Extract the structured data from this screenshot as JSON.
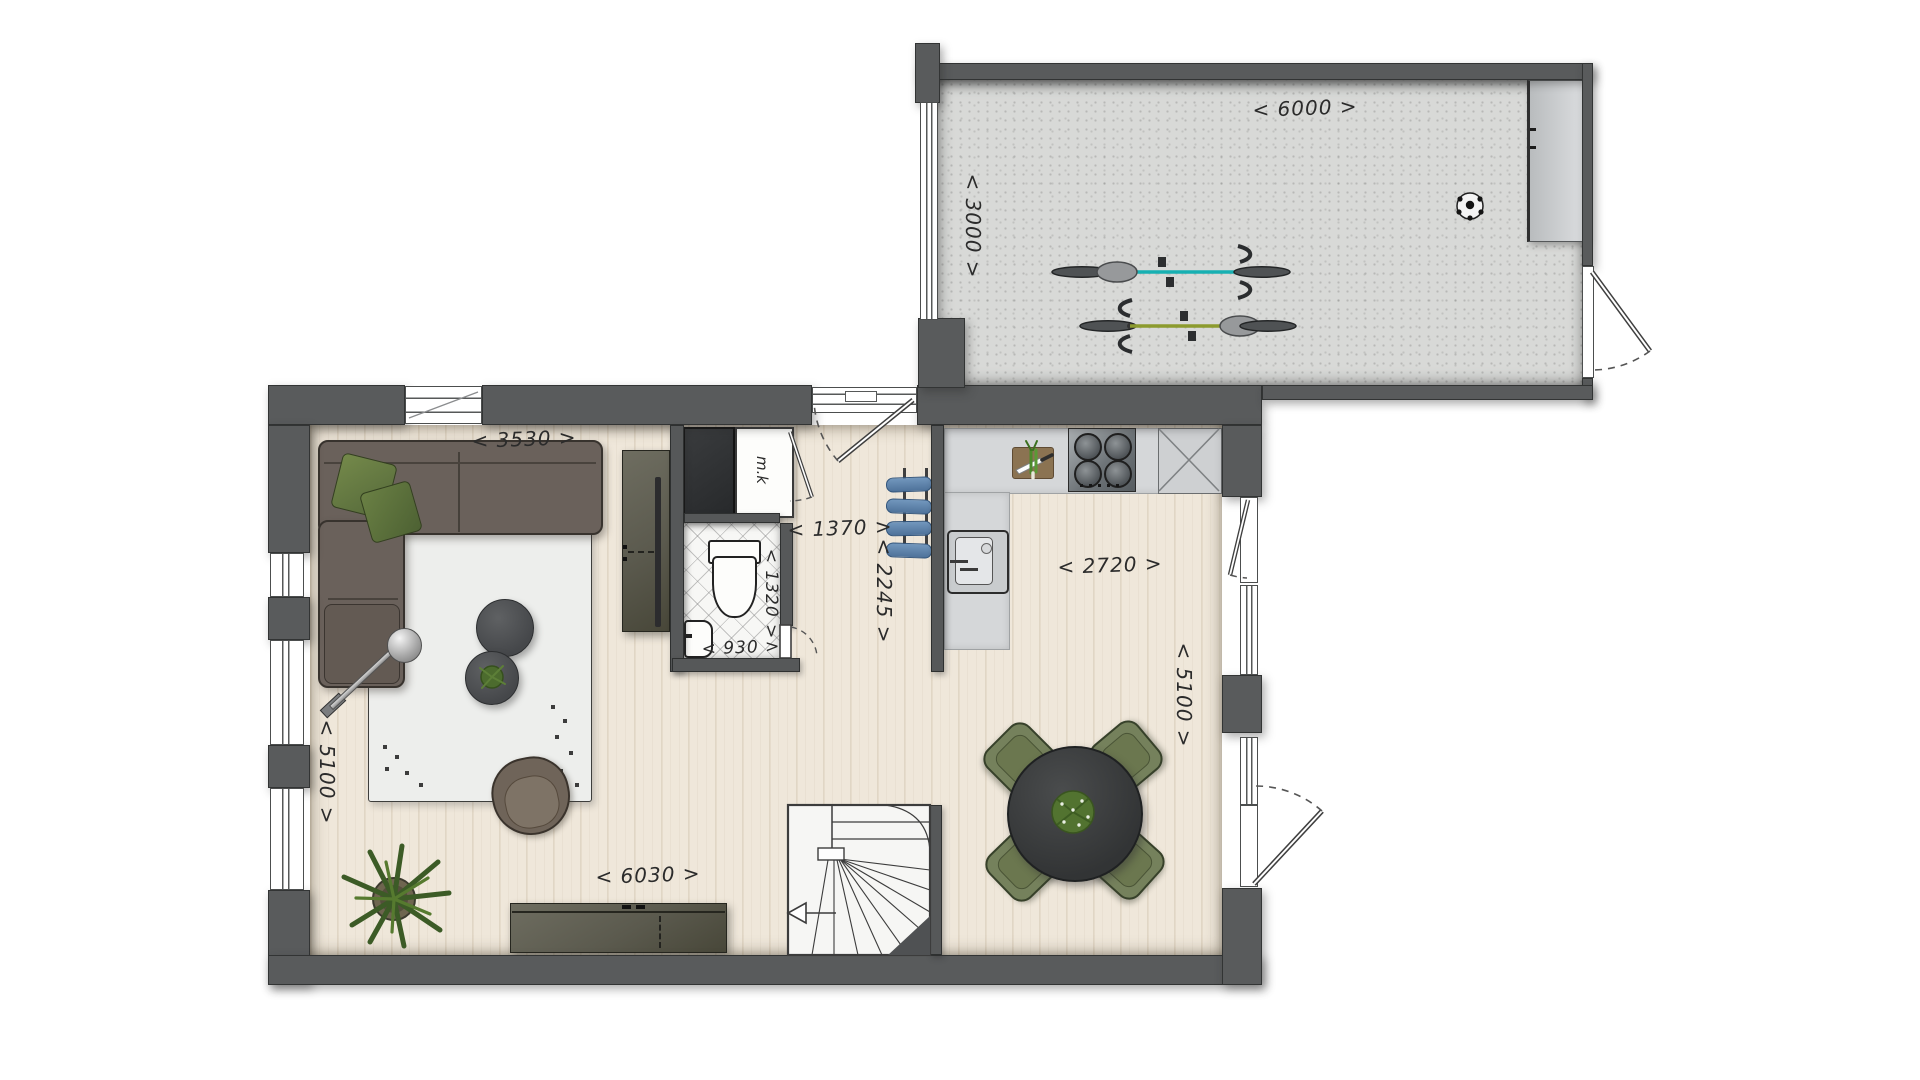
{
  "drawing": {
    "type": "architectural floor plan",
    "floor": "ground floor",
    "style": "hand-drawn colored plan, top view",
    "units": "millimetres"
  },
  "colors": {
    "wall": "#595b5c",
    "wood_floor": "#efe7da",
    "garage_floor": "#d8d9d7",
    "rug": "#edeeec",
    "sofa": "#6a615b",
    "pillow_green": "#66793f",
    "dining_chair_green": "#75815c",
    "table_dark": "#3e4041",
    "bicycle_teal": "#17b0b2",
    "bicycle_olive": "#8c9b2e",
    "coat_blue": "#5f87b2",
    "counter_gray": "#d5d7d9"
  },
  "dimensions": {
    "garage_width": {
      "value_mm": 6000,
      "label": "< 6000 >"
    },
    "garage_depth": {
      "value_mm": 3000,
      "label": "< 3000 >"
    },
    "living_width": {
      "value_mm": 3530,
      "label": "< 3530 >"
    },
    "living_depth": {
      "value_mm": 5100,
      "label": "< 5100 >"
    },
    "hall_width": {
      "value_mm": 1370,
      "label": "< 1370 >"
    },
    "hall_depth": {
      "value_mm": 2245,
      "label": "< 2245 >"
    },
    "toilet_depth": {
      "value_mm": 1320,
      "label": "< 1320 >"
    },
    "toilet_width": {
      "value_mm": 930,
      "label": "< 930 >"
    },
    "kitchen_width": {
      "value_mm": 2720,
      "label": "< 2720 >"
    },
    "kitchen_depth": {
      "value_mm": 5100,
      "label": "< 5100 >"
    },
    "house_width": {
      "value_mm": 6030,
      "label": "< 6030 >"
    }
  },
  "labels": {
    "meter_cupboard": "m.k"
  },
  "rooms": {
    "living_room": [
      "corner sofa with green cushions",
      "arc floor lamp",
      "two round coffee tables",
      "plant on coffee table",
      "armchair",
      "area rug",
      "floor plant",
      "tall tv cabinet",
      "sideboard"
    ],
    "hallway": [
      "front entrance door",
      "coat rack with four blue jackets",
      "meter cupboard m.k",
      "dark storage closet",
      "winder staircase with direction arrow"
    ],
    "toilet": [
      "toilet",
      "hand basin",
      "diagonal tiled floor",
      "door"
    ],
    "kitchen_dining": [
      "l-shaped counter",
      "sink",
      "four burner cooktop",
      "cutting board with knife and leek",
      "crossed appliance box",
      "round dining table with plant",
      "four green chairs",
      "side door",
      "garden door",
      "windows"
    ],
    "garage": [
      "teal bicycle",
      "olive bicycle",
      "soccer ball",
      "workbench cabinet",
      "side door with swing",
      "long window"
    ]
  }
}
